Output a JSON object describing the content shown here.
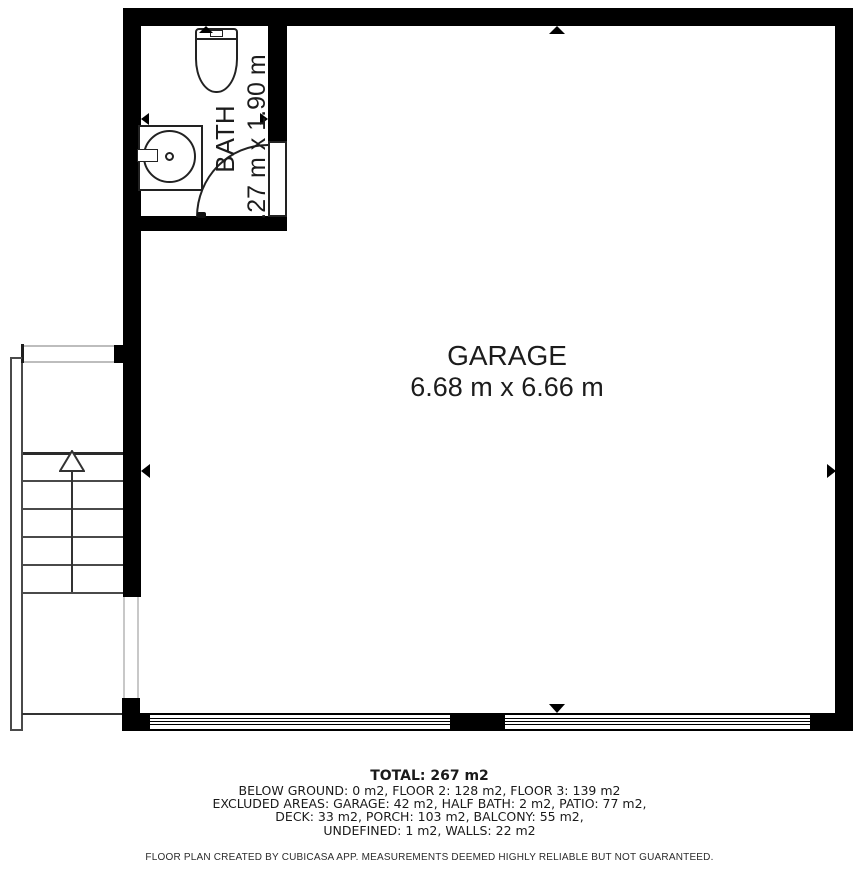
{
  "floor_plan": {
    "garage": {
      "name": "GARAGE",
      "dimensions": "6.68 m x 6.66 m"
    },
    "bath": {
      "name": "BATH",
      "dimensions": ".27 m x 1.90 m"
    }
  },
  "footer": {
    "total": "TOTAL: 267 m2",
    "area_lines": [
      "BELOW GROUND: 0 m2, FLOOR 2: 128 m2, FLOOR 3: 139 m2",
      "EXCLUDED AREAS: GARAGE: 42 m2, HALF BATH: 2 m2, PATIO: 77 m2,",
      "DECK: 33 m2, PORCH: 103 m2, BALCONY: 55 m2,",
      "UNDEFINED: 1 m2, WALLS: 22 m2"
    ],
    "disclaimer": "FLOOR PLAN CREATED BY CUBICASA APP. MEASUREMENTS DEEMED HIGHLY RELIABLE BUT NOT GUARANTEED."
  },
  "colors": {
    "wall": "#000000",
    "text": "#1c1c1c",
    "thin_line": "#4a4a4a",
    "light_line": "#bdbdbd"
  }
}
